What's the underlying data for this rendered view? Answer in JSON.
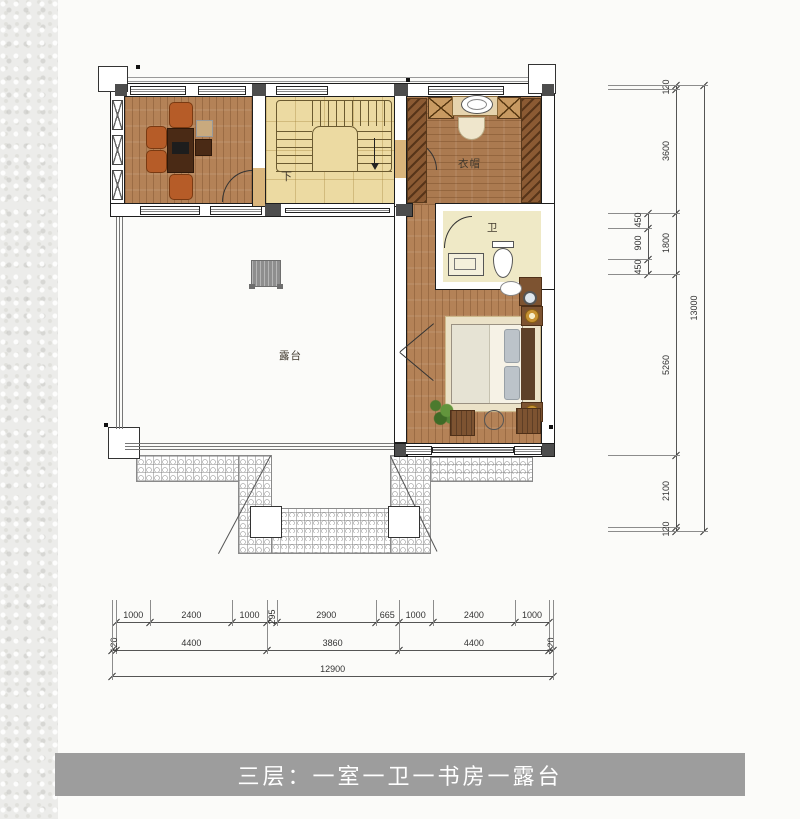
{
  "caption": {
    "text": "三层：一室一卫一书房一露台"
  },
  "labels": {
    "terrace": "露台",
    "cloakroom": "衣帽",
    "bathroom": "卫",
    "stairs_down": "下"
  },
  "dimensions": {
    "unit": "mm",
    "bottom": {
      "dir": "h",
      "origin": 112,
      "scale": 0.0342,
      "ext0": 600,
      "rows": [
        {
          "line": 622,
          "offset": 120,
          "segments": [
            1000,
            2400,
            1000,
            295,
            2900,
            665,
            1000,
            2400,
            1000
          ]
        },
        {
          "line": 650,
          "offset": 0,
          "segments": [
            120,
            4400,
            3860,
            4400,
            120
          ]
        },
        {
          "line": 676,
          "offset": 0,
          "segments": [
            12900
          ]
        }
      ]
    },
    "right": {
      "dir": "v",
      "origin": 85,
      "scale": 0.0343,
      "ext0": 608,
      "rows": [
        {
          "line": 676,
          "offset": 0,
          "segments": [
            120,
            3600,
            1800,
            5260,
            2100,
            120
          ]
        },
        {
          "line": 648,
          "offset": 3720,
          "segments": [
            450,
            900,
            450
          ]
        },
        {
          "line": 704,
          "offset": 0,
          "segments": [
            13000
          ]
        }
      ]
    }
  },
  "colors": {
    "wood_floor": "#b48257",
    "cloak_floor": "#ab7a50",
    "stair_floor": "#ecdaa2",
    "bath_floor": "#efe9c6",
    "wardrobe": "#8b5a33",
    "caption_bg": "#9d9d9d",
    "caption_text": "#ffffff",
    "wall_line": "#1d1d1d",
    "column": "#4d4d4d",
    "dim_text": "#333333"
  }
}
